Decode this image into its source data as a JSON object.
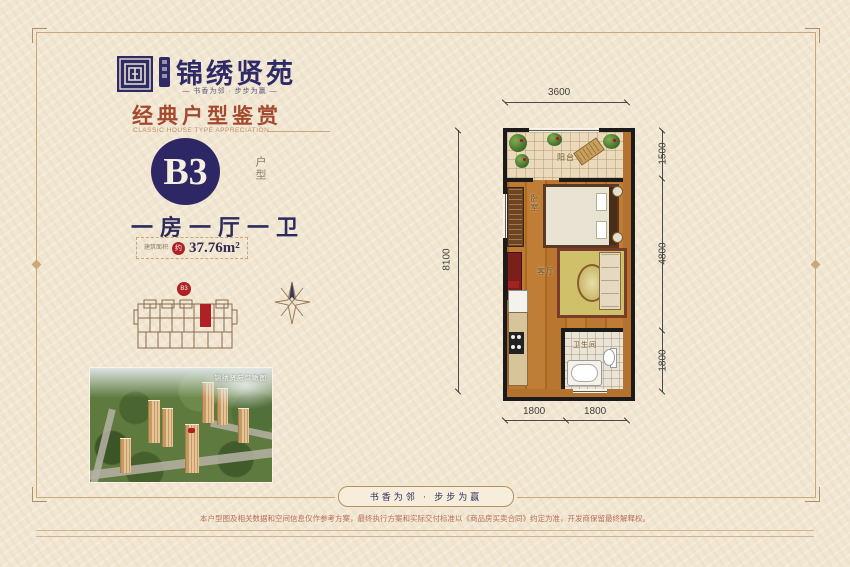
{
  "brand": {
    "name": "锦绣贤苑",
    "tagline": "—  书香为邻 · 步步为赢  —"
  },
  "section": {
    "title": "经典户型鉴赏",
    "subtitle": "CLASSIC HOUSE TYPE APPRECIATION"
  },
  "unit": {
    "code": "B3",
    "type_label": "户型",
    "layout": "一房一厅一卫",
    "area_label": "建筑面积",
    "area_approx": "约",
    "area_value": "37.76m²"
  },
  "siteplan": {
    "marker": "B3"
  },
  "photo": {
    "caption": "锦绣贤苑鸟瞰图"
  },
  "floorplan": {
    "rooms": {
      "balcony": "阳台",
      "bedroom": "卧室",
      "living": "客厅",
      "bathroom": "卫生间"
    },
    "dims": {
      "top": "3600",
      "left": "8100",
      "right": [
        "1500",
        "4800",
        "1800"
      ],
      "bottom": [
        "1800",
        "1800"
      ]
    }
  },
  "footer": {
    "banner": "书香为邻 · 步步为赢",
    "disclaimer": "本户型图及相关数据和空间信息仅作参考方案，最终执行方案和实际交付标准以《商品房买卖合同》约定为准，开发商保留最终解释权。"
  },
  "colors": {
    "brand_navy": "#2d2766",
    "heading_red": "#a34a2e",
    "accent_red": "#b02125",
    "background": "#f2e7d2"
  }
}
